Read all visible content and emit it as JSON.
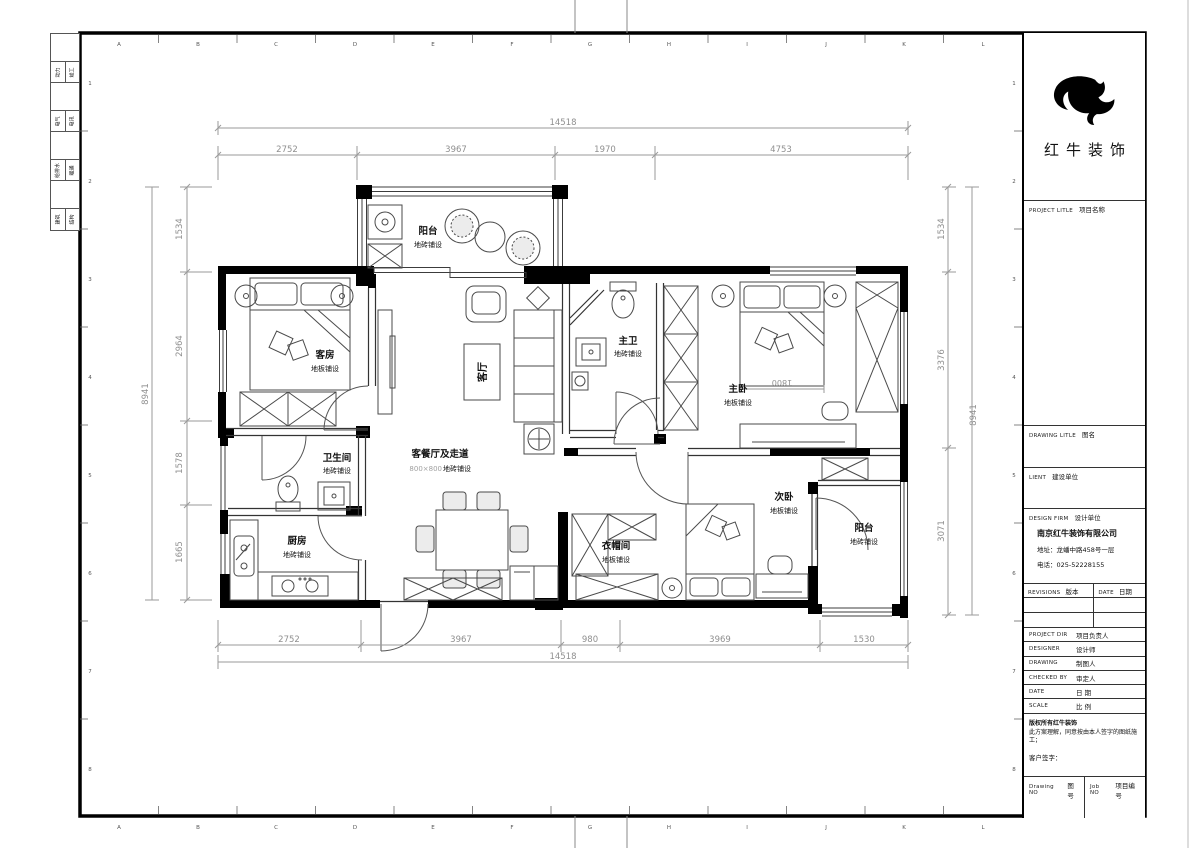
{
  "palette": {
    "wall": "#000000",
    "line": "#3c3c3c",
    "dim": "#8f8f8f",
    "paper": "#ffffff"
  },
  "sheet": {
    "grid_letters": [
      "A",
      "B",
      "C",
      "D",
      "E",
      "F",
      "G",
      "H",
      "I",
      "J",
      "K",
      "L"
    ],
    "grid_numbers": [
      "1",
      "2",
      "3",
      "4",
      "5",
      "6",
      "7",
      "8"
    ],
    "disciplines": [
      {
        "left": "动力",
        "right": "竣工"
      },
      {
        "left": "电气",
        "right": "电讯"
      },
      {
        "left": "给排水",
        "right": "暖通"
      },
      {
        "left": "建筑",
        "right": "结构"
      }
    ]
  },
  "title_block": {
    "brand": "红牛装饰",
    "sections": {
      "project_title": {
        "en": "PROJECT LITLE",
        "cn": "项目名称"
      },
      "drawing_title": {
        "en": "DRAWING LITLE",
        "cn": "图名"
      },
      "client": {
        "en": "LIENT",
        "cn": "建设单位"
      },
      "design_firm": {
        "en": "DESIGN FIRM",
        "cn": "设计单位"
      }
    },
    "firm": {
      "name": "南京红牛装饰有限公司",
      "address": "地址：龙蟠中路458号一层",
      "phone": "电话：025-52228155"
    },
    "revision_header": {
      "rev_en": "REVISIONS",
      "rev_cn": "版本",
      "date_en": "DATE",
      "date_cn": "日期"
    },
    "rows": [
      {
        "en": "PROJECT DIR",
        "cn": "项目负责人"
      },
      {
        "en": "DESIGNER",
        "cn": "设计师"
      },
      {
        "en": "DRAWING",
        "cn": "制图人"
      },
      {
        "en": "CHECKED BY",
        "cn": "审定人"
      },
      {
        "en": "DATE",
        "cn": "日 期"
      },
      {
        "en": "SCALE",
        "cn": "比 例"
      }
    ],
    "copyright_line1": "版权所有红牛装饰",
    "copyright_line2": "此方案理解，同意按由本人签字的图纸施工；",
    "signature_label": "客户签字：",
    "footer": {
      "drawing_no_en": "Drawing NO",
      "drawing_no_cn": "图号",
      "job_no_en": "Job NO",
      "job_no_cn": "项目编号"
    }
  },
  "plan": {
    "rooms": {
      "balcony_top": {
        "name": "阳台",
        "finish": "地砖铺设"
      },
      "guest_room": {
        "name": "客房",
        "finish": "地板铺设"
      },
      "living": {
        "name": "客厅"
      },
      "master_bath": {
        "name": "主卫",
        "finish": "地砖铺设"
      },
      "master_bed": {
        "name": "主卧",
        "finish": "地板铺设"
      },
      "bath": {
        "name": "卫生间",
        "finish": "地砖铺设"
      },
      "kitchen": {
        "name": "厨房",
        "finish": "地砖铺设"
      },
      "dining_hall": {
        "name": "客餐厅及走道",
        "finish_size": "800×800",
        "finish": "地砖铺设"
      },
      "cloak_room": {
        "name": "衣帽间",
        "finish": "地板铺设"
      },
      "second_bed": {
        "name": "次卧",
        "finish": "地板铺设"
      },
      "balcony_bottom": {
        "name": "阳台",
        "finish": "地砖铺设"
      }
    },
    "dimensions": {
      "top_overall": "14518",
      "top_segments": [
        "2752",
        "3967",
        "1970",
        "4753"
      ],
      "bottom_segments": [
        "2752",
        "3967",
        "980",
        "3969",
        "1530"
      ],
      "bottom_overall": "14518",
      "left_overall": "8941",
      "left_segments": [
        "1534",
        "2964",
        "1578",
        "1665"
      ],
      "right_segments": [
        "1534",
        "3376",
        "3071"
      ],
      "right_overall": "8941",
      "bed_width": "1800"
    }
  }
}
